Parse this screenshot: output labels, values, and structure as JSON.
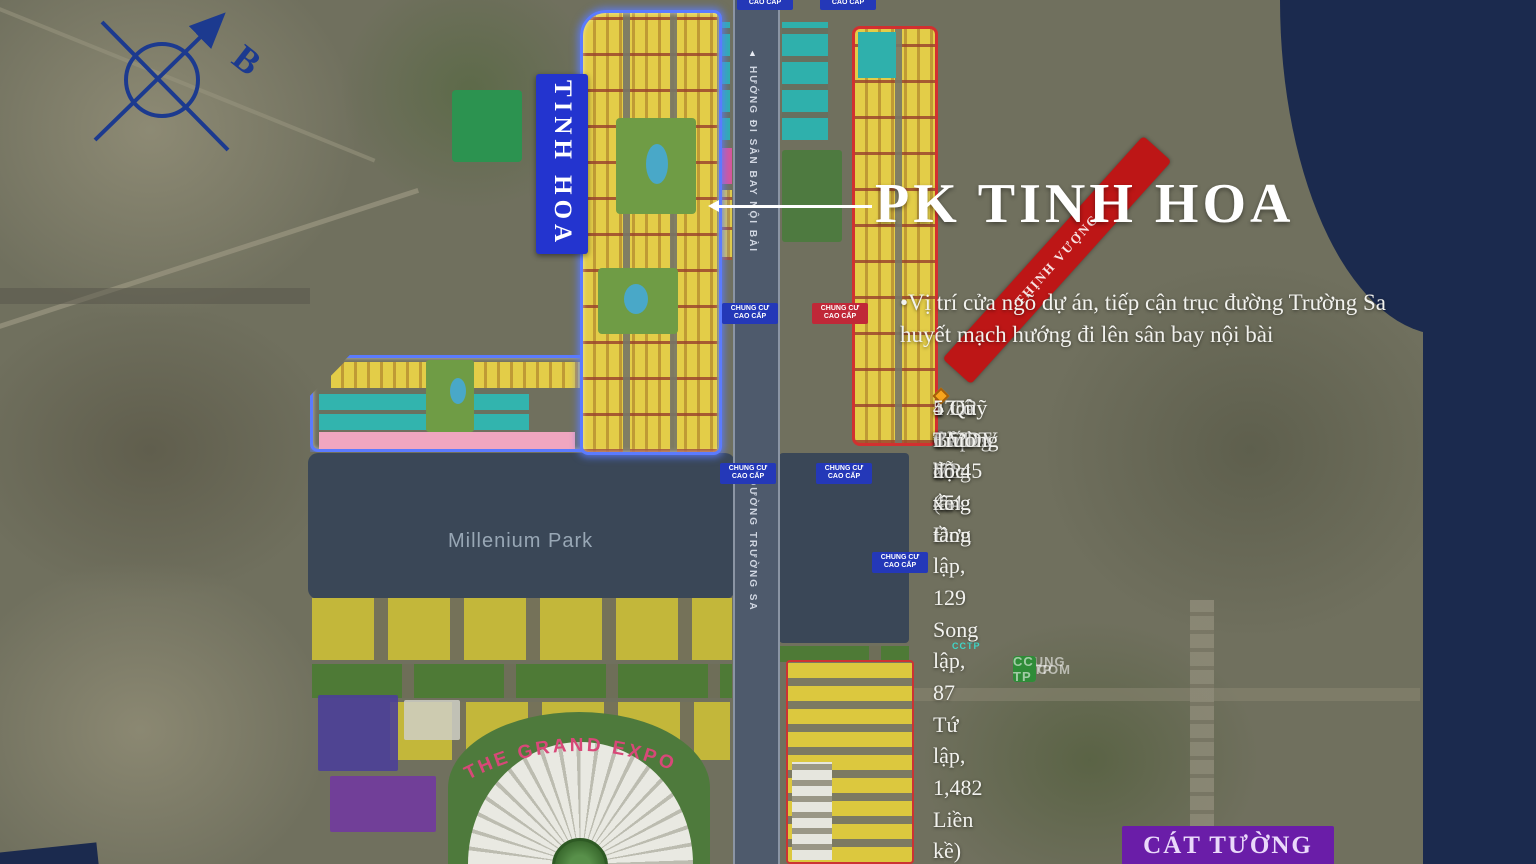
{
  "annotation": {
    "title": "PK TINH HOA",
    "description": "•Vị trí cửa ngõ dự án, tiếp cận trục đường Trường Sa huyết mạch hướng đi lên sân bay nội bài",
    "bullets": [
      "1752 thấp tầng (54 Đơn lập, 129 Song lập, 87 Tứ lập, 1,482 Liền kề)",
      "4 toà Chung cư 45 tầng",
      "1 toà VP 45 tầng",
      "1 Lô CCDT 25 tầng",
      "1 Bãi đỗ xe",
      "4 Quỹ TMDV",
      "5 Trường học"
    ],
    "bullet_color": "#f7a51d"
  },
  "legend": {
    "items": [
      {
        "label": "CCTP",
        "color": "#b5a526"
      },
      {
        "label": "CHUNG CU",
        "color": "#17889a"
      },
      {
        "label": "VINCOM",
        "color": "#bf5a8a"
      },
      {
        "label": "CC TP",
        "color": "#2f8c38"
      }
    ]
  },
  "map": {
    "compass_label": "B",
    "airport_arrow_icon": "▲",
    "zone_banner": "TINH HOA",
    "ribbon_label": "THỊNH VƯỢNG",
    "park_label": "Millenium Park",
    "expo_label": "THE GRAND EXPO",
    "district_label": "CÁT TƯỜNG",
    "road_label": "ĐƯỜNG TRƯỜNG SA",
    "airport_road_label": "HƯỚNG ĐI SÂN BAY NỘI BÀI",
    "badge_label": "CHUNG CƯ CAO CẤP",
    "cctp_tag": "CCTP"
  },
  "colors": {
    "zone_outline_blue": "#5b7bff",
    "zone_outline_red": "#d23030",
    "banner_blue": "#2334cf",
    "ribbon_red": "#bd1616",
    "district_purple": "#6a1da8",
    "navy": "#1b2a4e"
  }
}
